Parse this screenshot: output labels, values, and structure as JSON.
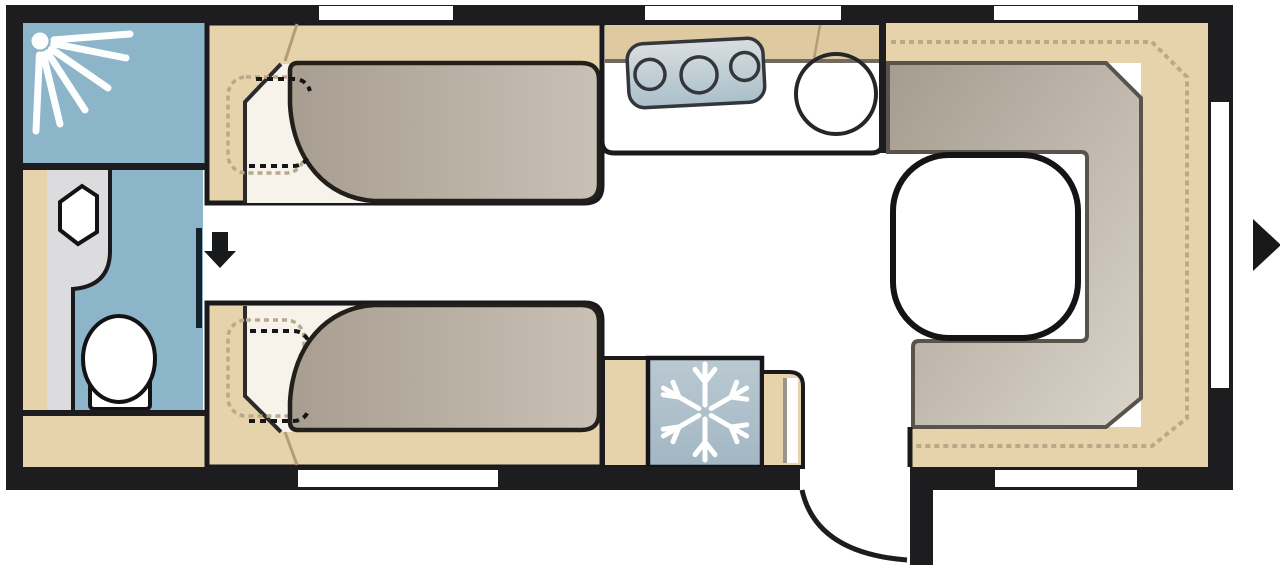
{
  "diagram": {
    "title": "Caravan floor plan (top view)",
    "rooms": [
      {
        "name": "washroom",
        "features": [
          "shower-cubicle",
          "shower-spray",
          "wash-basin",
          "toilet",
          "sliding-door"
        ]
      },
      {
        "name": "bedroom",
        "features": [
          "single-bed-top",
          "single-bed-bottom",
          "pillow-outlines",
          "center-aisle"
        ]
      },
      {
        "name": "kitchen",
        "features": [
          "worktop",
          "hob-3-burners",
          "round-sink"
        ]
      },
      {
        "name": "refrigerator",
        "features": [
          "snowflake-symbol"
        ]
      },
      {
        "name": "lounge",
        "features": [
          "u-shaped-seating",
          "seat-cushion",
          "backrest-dashed-outline",
          "table"
        ]
      },
      {
        "name": "wardrobe",
        "features": [
          "storage-cabinet-left",
          "cabinet-beside-fridge",
          "cabinet-beside-door"
        ]
      }
    ],
    "openings": {
      "window_count": 6,
      "entry_door": "rear right with quarter-circle swing arc",
      "interior_door": "washroom door line in aisle",
      "arrows": [
        "entry-arrow-down-in-aisle",
        "direction-arrow-right-outside-front"
      ]
    }
  },
  "colors": {
    "wall": "#1d1d20",
    "floor": "#ffffff",
    "tan": "#e6d2ab",
    "tan_dark": "#dfc9a0",
    "crease": "#b59c73",
    "blue": "#8db5c9",
    "fridge_blue_1": "#bac9d2",
    "fridge_blue_2": "#a2b7c3",
    "gray_panel": "#dcdcde",
    "off_white": "#f7f3eb",
    "mattress_1": "#a79d90",
    "mattress_2": "#c9c1b6",
    "cushion_1": "#a59c8f",
    "cushion_2": "#dad4ca",
    "dash_beige": "#b9a98a",
    "stove_1": "#d9dee0",
    "stove_2": "#aabfca",
    "stroke_dark": "#1a1a1e",
    "band_line": "#6f6a62",
    "door_line": "#14222b",
    "arrow": "#17191b",
    "white": "#ffffff"
  }
}
